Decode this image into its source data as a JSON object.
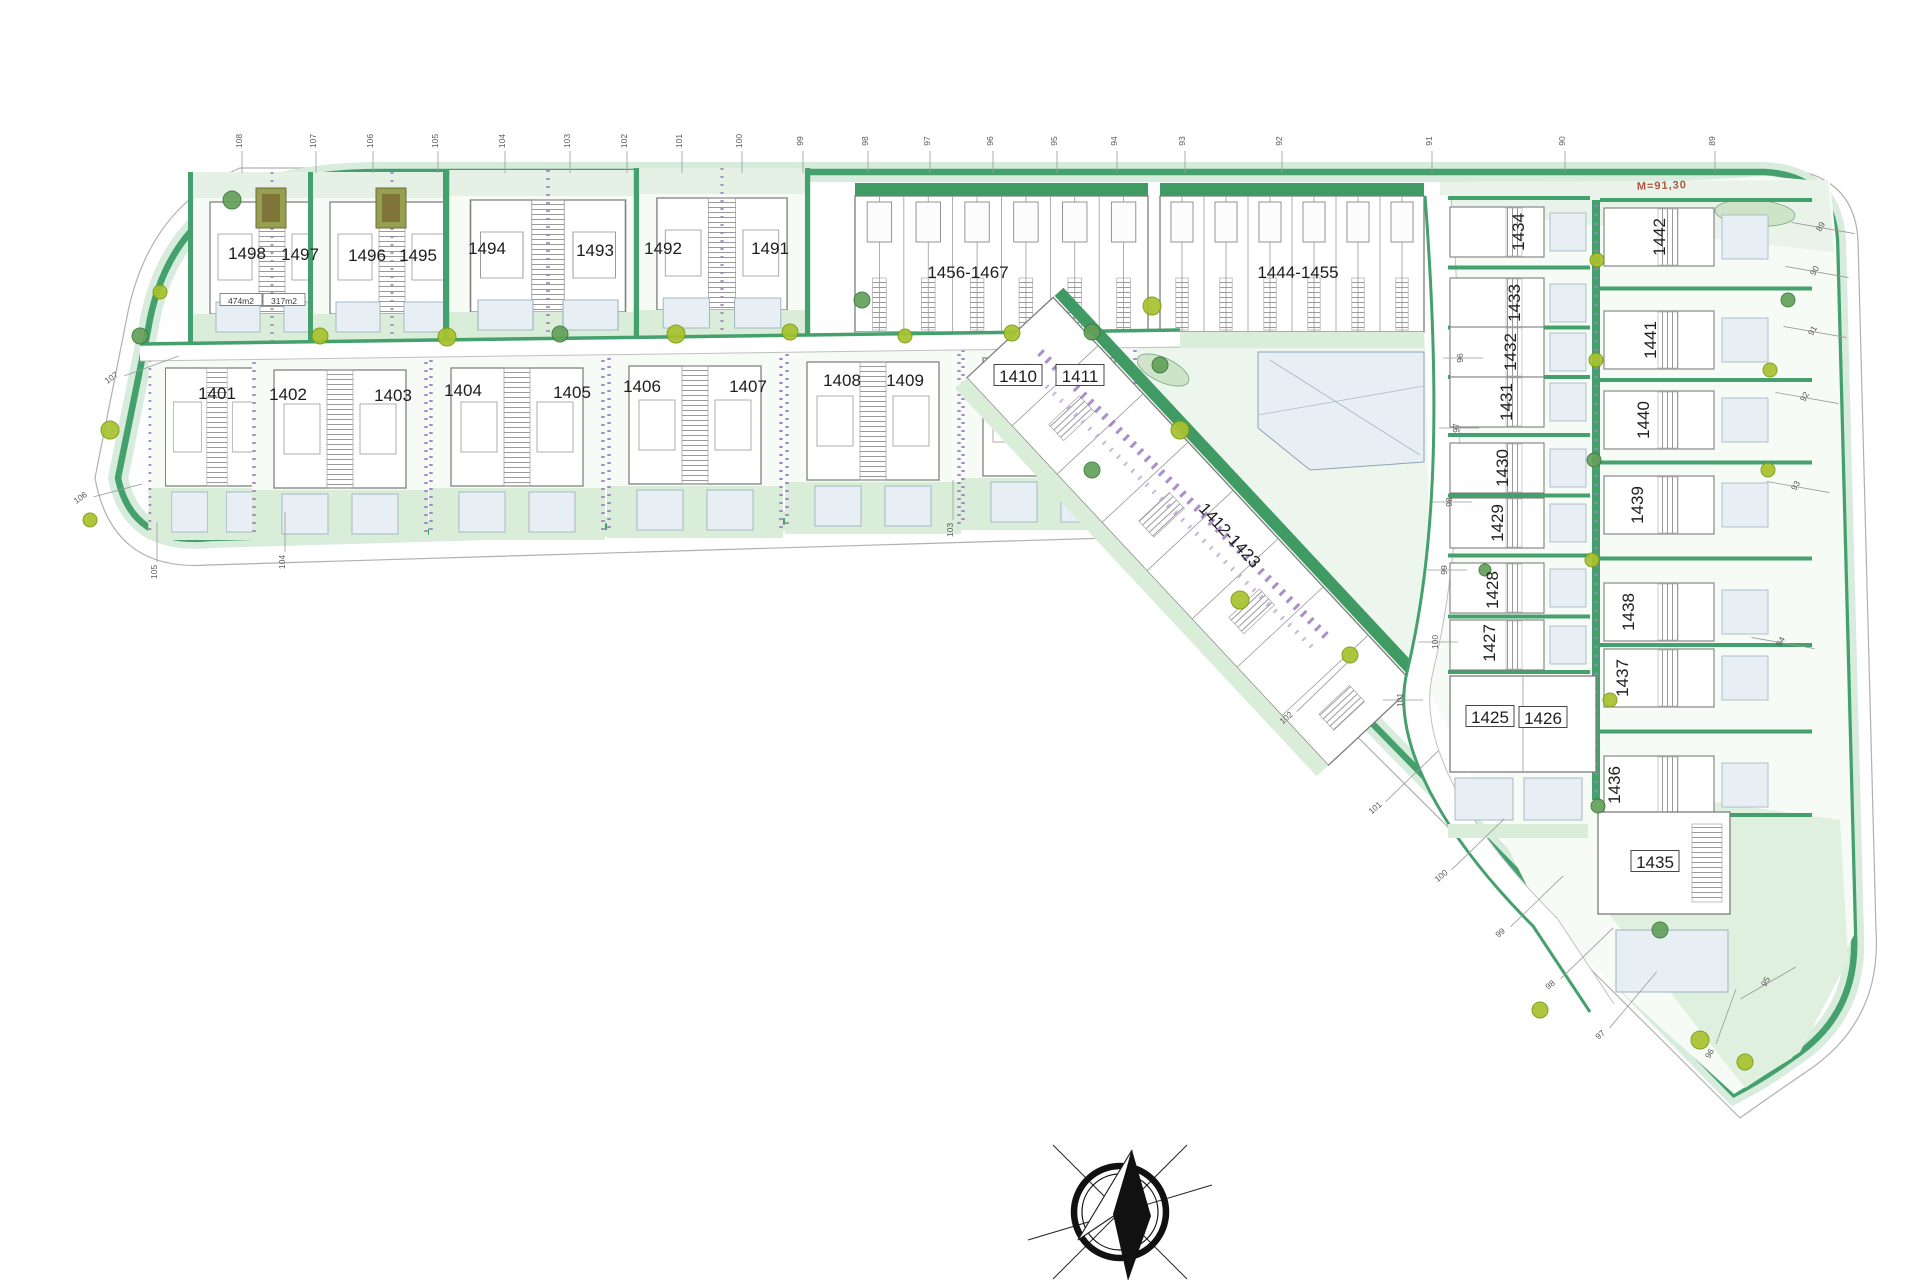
{
  "document": {
    "type": "residential-site-plan",
    "compass": "north-arrow"
  },
  "colors": {
    "hedge_green": "#44a06c",
    "lawn_light": "#d9edd9",
    "lawn_pale": "#eef6ee",
    "pool_blue": "#e7eff5",
    "purple_hedge": "#a184c4",
    "lime_tree": "#a8c22e",
    "note_red": "#b0563e",
    "building_line": "#7d7d7d"
  },
  "map": {
    "plot_labels": [
      {
        "id": "1498",
        "x": 247,
        "y": 253,
        "rot": 0
      },
      {
        "id": "1497",
        "x": 300,
        "y": 254,
        "rot": 0
      },
      {
        "id": "1496",
        "x": 367,
        "y": 255,
        "rot": 0
      },
      {
        "id": "1495",
        "x": 418,
        "y": 255,
        "rot": 0
      },
      {
        "id": "1494",
        "x": 487,
        "y": 248,
        "rot": 0
      },
      {
        "id": "1493",
        "x": 595,
        "y": 250,
        "rot": 0
      },
      {
        "id": "1492",
        "x": 663,
        "y": 248,
        "rot": 0
      },
      {
        "id": "1491",
        "x": 770,
        "y": 248,
        "rot": 0
      },
      {
        "id": "1456-1467",
        "x": 968,
        "y": 272,
        "rot": 0
      },
      {
        "id": "1444-1455",
        "x": 1298,
        "y": 272,
        "rot": 0
      },
      {
        "id": "1401",
        "x": 217,
        "y": 393,
        "rot": 0
      },
      {
        "id": "1402",
        "x": 288,
        "y": 394,
        "rot": 0
      },
      {
        "id": "1403",
        "x": 393,
        "y": 395,
        "rot": 0
      },
      {
        "id": "1404",
        "x": 463,
        "y": 390,
        "rot": 0
      },
      {
        "id": "1405",
        "x": 572,
        "y": 392,
        "rot": 0
      },
      {
        "id": "1406",
        "x": 642,
        "y": 386,
        "rot": 0
      },
      {
        "id": "1407",
        "x": 748,
        "y": 386,
        "rot": 0
      },
      {
        "id": "1408",
        "x": 842,
        "y": 380,
        "rot": 0
      },
      {
        "id": "1409",
        "x": 905,
        "y": 380,
        "rot": 0
      },
      {
        "id": "1410",
        "x": 1018,
        "y": 376,
        "rot": 0,
        "boxed": true
      },
      {
        "id": "1411",
        "x": 1080,
        "y": 376,
        "rot": 0,
        "boxed": true
      },
      {
        "id": "1412-1423",
        "x": 1230,
        "y": 535,
        "rot": 47
      },
      {
        "id": "1434",
        "x": 1518,
        "y": 232,
        "rot": -90
      },
      {
        "id": "1433",
        "x": 1514,
        "y": 303,
        "rot": -90
      },
      {
        "id": "1432",
        "x": 1510,
        "y": 352,
        "rot": -90
      },
      {
        "id": "1431",
        "x": 1506,
        "y": 402,
        "rot": -90
      },
      {
        "id": "1430",
        "x": 1502,
        "y": 468,
        "rot": -90
      },
      {
        "id": "1429",
        "x": 1497,
        "y": 523,
        "rot": -90
      },
      {
        "id": "1428",
        "x": 1492,
        "y": 590,
        "rot": -90
      },
      {
        "id": "1427",
        "x": 1489,
        "y": 643,
        "rot": -90
      },
      {
        "id": "1425",
        "x": 1490,
        "y": 717,
        "rot": 0,
        "boxed": true
      },
      {
        "id": "1426",
        "x": 1543,
        "y": 718,
        "rot": 0,
        "boxed": true
      },
      {
        "id": "1442",
        "x": 1659,
        "y": 237,
        "rot": -90
      },
      {
        "id": "1441",
        "x": 1650,
        "y": 340,
        "rot": -90
      },
      {
        "id": "1440",
        "x": 1643,
        "y": 420,
        "rot": -90
      },
      {
        "id": "1439",
        "x": 1637,
        "y": 505,
        "rot": -90
      },
      {
        "id": "1438",
        "x": 1628,
        "y": 612,
        "rot": -90
      },
      {
        "id": "1437",
        "x": 1622,
        "y": 678,
        "rot": -90
      },
      {
        "id": "1436",
        "x": 1614,
        "y": 785,
        "rot": -90
      },
      {
        "id": "1435",
        "x": 1655,
        "y": 862,
        "rot": 0,
        "boxed": true
      }
    ],
    "stations": [
      {
        "label": "108",
        "x": 242,
        "y": 141,
        "rot": -90,
        "la": 90,
        "r1": 10,
        "r2": 32
      },
      {
        "label": "107",
        "x": 316,
        "y": 141,
        "rot": -90,
        "la": 90,
        "r1": 10,
        "r2": 32
      },
      {
        "label": "106",
        "x": 373,
        "y": 141,
        "rot": -90,
        "la": 90,
        "r1": 10,
        "r2": 32
      },
      {
        "label": "105",
        "x": 438,
        "y": 141,
        "rot": -90,
        "la": 90,
        "r1": 10,
        "r2": 32
      },
      {
        "label": "104",
        "x": 505,
        "y": 141,
        "rot": -90,
        "la": 90,
        "r1": 10,
        "r2": 32
      },
      {
        "label": "103",
        "x": 570,
        "y": 141,
        "rot": -90,
        "la": 90,
        "r1": 10,
        "r2": 32
      },
      {
        "label": "102",
        "x": 627,
        "y": 141,
        "rot": -90,
        "la": 90,
        "r1": 10,
        "r2": 32
      },
      {
        "label": "101",
        "x": 682,
        "y": 141,
        "rot": -90,
        "la": 90,
        "r1": 10,
        "r2": 32
      },
      {
        "label": "100",
        "x": 742,
        "y": 141,
        "rot": -90,
        "la": 90,
        "r1": 10,
        "r2": 32
      },
      {
        "label": "99",
        "x": 803,
        "y": 141,
        "rot": -90,
        "la": 90,
        "r1": 10,
        "r2": 32
      },
      {
        "label": "98",
        "x": 868,
        "y": 141,
        "rot": -90,
        "la": 90,
        "r1": 10,
        "r2": 32
      },
      {
        "label": "97",
        "x": 930,
        "y": 141,
        "rot": -90,
        "la": 90,
        "r1": 10,
        "r2": 32
      },
      {
        "label": "96",
        "x": 993,
        "y": 141,
        "rot": -90,
        "la": 90,
        "r1": 10,
        "r2": 32
      },
      {
        "label": "95",
        "x": 1057,
        "y": 141,
        "rot": -90,
        "la": 90,
        "r1": 10,
        "r2": 32
      },
      {
        "label": "94",
        "x": 1117,
        "y": 141,
        "rot": -90,
        "la": 90,
        "r1": 10,
        "r2": 32
      },
      {
        "label": "93",
        "x": 1185,
        "y": 141,
        "rot": -90,
        "la": 90,
        "r1": 10,
        "r2": 32
      },
      {
        "label": "92",
        "x": 1282,
        "y": 141,
        "rot": -90,
        "la": 90,
        "r1": 10,
        "r2": 32
      },
      {
        "label": "91",
        "x": 1432,
        "y": 141,
        "rot": -90,
        "la": 90,
        "r1": 10,
        "r2": 32
      },
      {
        "label": "90",
        "x": 1565,
        "y": 141,
        "rot": -90,
        "la": 90,
        "r1": 10,
        "r2": 32
      },
      {
        "label": "89",
        "x": 1715,
        "y": 141,
        "rot": -90,
        "la": 90,
        "r1": 10,
        "r2": 32
      },
      {
        "label": "89",
        "x": 1823,
        "y": 228,
        "rot": -60,
        "la": 10,
        "r1": -32,
        "r2": 32
      },
      {
        "label": "90",
        "x": 1817,
        "y": 272,
        "rot": -60,
        "la": 10,
        "r1": -32,
        "r2": 32
      },
      {
        "label": "91",
        "x": 1815,
        "y": 332,
        "rot": -60,
        "la": 10,
        "r1": -32,
        "r2": 32
      },
      {
        "label": "92",
        "x": 1807,
        "y": 398,
        "rot": -60,
        "la": 10,
        "r1": -32,
        "r2": 32
      },
      {
        "label": "93",
        "x": 1798,
        "y": 487,
        "rot": -60,
        "la": 10,
        "r1": -32,
        "r2": 32
      },
      {
        "label": "94",
        "x": 1783,
        "y": 643,
        "rot": -60,
        "la": 10,
        "r1": -32,
        "r2": 32
      },
      {
        "label": "95",
        "x": 1768,
        "y": 983,
        "rot": -60,
        "la": -30,
        "r1": -32,
        "r2": 32
      },
      {
        "label": "102",
        "x": 1288,
        "y": 720,
        "rot": -40,
        "la": -44,
        "r1": 12,
        "r2": 85
      },
      {
        "label": "101",
        "x": 1377,
        "y": 810,
        "rot": -40,
        "la": -44,
        "r1": 12,
        "r2": 85
      },
      {
        "label": "100",
        "x": 1443,
        "y": 878,
        "rot": -40,
        "la": -44,
        "r1": 12,
        "r2": 85
      },
      {
        "label": "99",
        "x": 1502,
        "y": 935,
        "rot": -40,
        "la": -44,
        "r1": 12,
        "r2": 85
      },
      {
        "label": "98",
        "x": 1552,
        "y": 987,
        "rot": -40,
        "la": -44,
        "r1": 12,
        "r2": 85
      },
      {
        "label": "97",
        "x": 1602,
        "y": 1037,
        "rot": -40,
        "la": -50,
        "r1": 12,
        "r2": 85
      },
      {
        "label": "96",
        "x": 1712,
        "y": 1055,
        "rot": -60,
        "la": -70,
        "r1": 12,
        "r2": 70
      },
      {
        "label": "105",
        "x": 157,
        "y": 572,
        "rot": -90,
        "la": -90,
        "r1": 10,
        "r2": 50
      },
      {
        "label": "104",
        "x": 285,
        "y": 562,
        "rot": -90,
        "la": -90,
        "r1": 10,
        "r2": 50
      },
      {
        "label": "103",
        "x": 953,
        "y": 530,
        "rot": -90,
        "la": -90,
        "r1": 10,
        "r2": 50
      },
      {
        "label": "107",
        "x": 113,
        "y": 380,
        "rot": -35,
        "la": -20,
        "r1": 12,
        "r2": 70
      },
      {
        "label": "106",
        "x": 82,
        "y": 500,
        "rot": -35,
        "la": -15,
        "r1": 12,
        "r2": 62
      },
      {
        "label": "96",
        "x": 1463,
        "y": 358,
        "rot": -90,
        "la": 0,
        "r1": -20,
        "r2": 20
      },
      {
        "label": "97",
        "x": 1459,
        "y": 428,
        "rot": -90,
        "la": 0,
        "r1": -20,
        "r2": 20
      },
      {
        "label": "98",
        "x": 1452,
        "y": 502,
        "rot": -90,
        "la": 0,
        "r1": -20,
        "r2": 20
      },
      {
        "label": "99",
        "x": 1447,
        "y": 570,
        "rot": -90,
        "la": 0,
        "r1": -20,
        "r2": 20
      },
      {
        "label": "100",
        "x": 1438,
        "y": 642,
        "rot": -90,
        "la": 0,
        "r1": -20,
        "r2": 20
      },
      {
        "label": "101",
        "x": 1403,
        "y": 700,
        "rot": -90,
        "la": 0,
        "r1": -20,
        "r2": 20
      }
    ],
    "area_labels": [
      {
        "text": "474m2",
        "x": 241,
        "y": 301
      },
      {
        "text": "317m2",
        "x": 284,
        "y": 301
      }
    ],
    "level_note": {
      "text": "M=91,30",
      "x": 1662,
      "y": 189
    }
  }
}
